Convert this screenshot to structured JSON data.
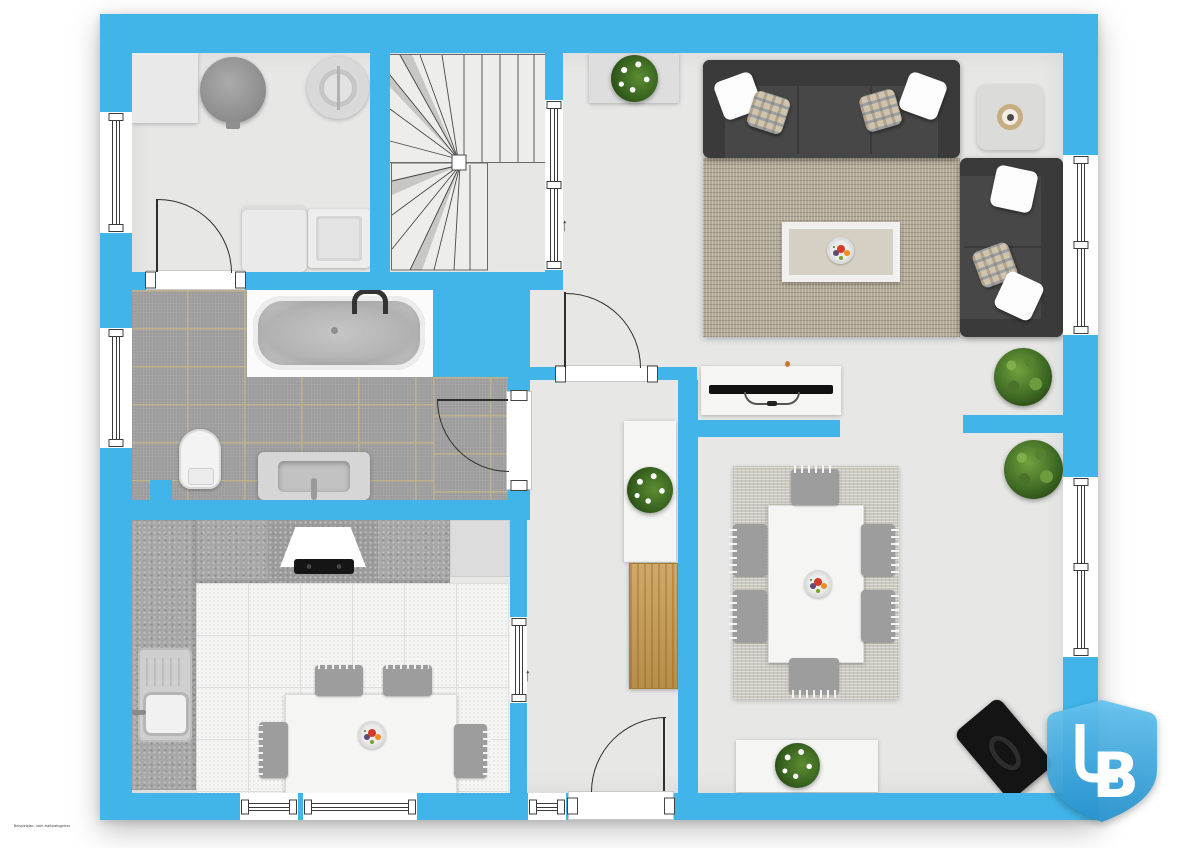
{
  "document": {
    "type": "floor-plan-top-view",
    "disclaimer": "Beispielplan, nicht maßstabsgetreu"
  },
  "logo": {
    "text": "LB",
    "letter_l": "L",
    "letter_b": "B",
    "shape": "shield",
    "color_top": "#64c3f0",
    "color_bottom": "#2694d0",
    "letter_color": "#ffffff"
  },
  "annotations": {
    "stair_direction_arrow": "↑",
    "hall_direction_arrow": "↑"
  },
  "colors": {
    "wall": "#41b5e9",
    "floor": "#e7e7e6",
    "bath_tile": "#9a9a9a",
    "tile_grout": "#c3b487",
    "kitchen_counter": "#a7a7a7",
    "kitchen_floor": "#f5f5f4",
    "sofa": "#474747",
    "living_rug": "#b2a996",
    "dining_rug": "#ccc9c0",
    "wood_dresser": "#c79a4e",
    "furniture_white": "#f5f5f4",
    "plant_green": "#3f6b24"
  },
  "rooms": {
    "utility_room": {
      "furniture": [
        "storage-cabinet",
        "water-tank",
        "boiler",
        "washing-machine",
        "dryer"
      ],
      "openings": [
        "door-to-hall",
        "window-left"
      ]
    },
    "staircase": {
      "type": "u-shaped-winder-stairs"
    },
    "living_room": {
      "furniture": [
        "sideboard",
        "flower-plant",
        "three-seat-sofa",
        "two-throw-pillow-pairs",
        "side-table-with-tray",
        "two-seat-sofa",
        "area-rug",
        "coffee-table",
        "fruit-bowl",
        "tv-lowboard",
        "flatscreen-tv",
        "potted-plant",
        "potted-plant"
      ],
      "openings": [
        "door-to-hall",
        "interior-window-to-stairs",
        "two-windows-right",
        "passage-to-dining"
      ]
    },
    "bathroom": {
      "furniture": [
        "bathtub",
        "toilet",
        "vanity-sink"
      ],
      "openings": [
        "door-to-hall",
        "window-left"
      ]
    },
    "kitchen": {
      "furniture": [
        "l-shaped-granite-counter",
        "extractor-hood",
        "cooktop",
        "tall-cabinet",
        "sink",
        "kitchen-table",
        "four-chairs",
        "fruit-bowl"
      ],
      "openings": [
        "two-windows-bottom",
        "interior-window-to-hall"
      ]
    },
    "hallway": {
      "furniture": [
        "console-table",
        "flower-plant",
        "wooden-dresser"
      ],
      "openings": [
        "entrance-door",
        "sidelight-window"
      ]
    },
    "dining_room": {
      "furniture": [
        "area-rug",
        "dining-table",
        "six-chairs",
        "fruit-bowl",
        "sideboard",
        "flower-plant",
        "black-lounge-chair"
      ],
      "openings": [
        "passage-to-living"
      ]
    }
  }
}
